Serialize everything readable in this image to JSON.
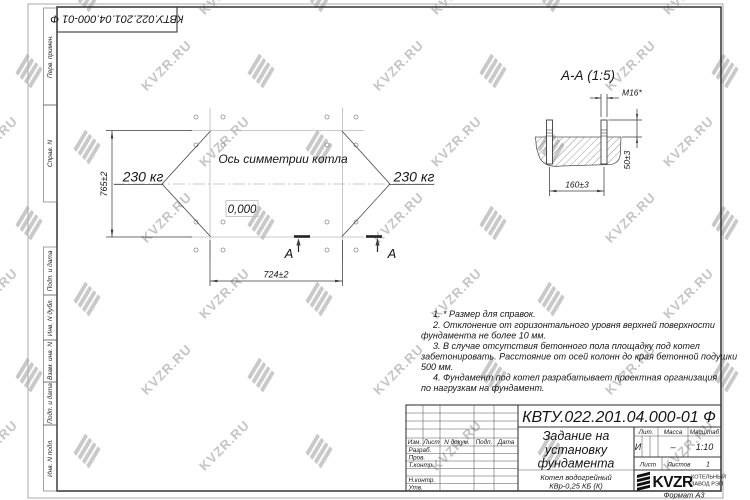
{
  "sheet": {
    "designation": "КВТУ.022.201.04.000-01 Ф",
    "format_label": "Формат А3",
    "watermark_text": "KVZR.RU"
  },
  "margin_labels": [
    "Перв. примен.",
    "Справ. N",
    "Подп. и дата",
    "Инв. N дубл.",
    "Взам. инв. N",
    "Подп. и дата",
    "Инв. N подл."
  ],
  "plan": {
    "axis_label": "Ось симметрии котла",
    "level_mark": "0,000",
    "load_left": "230 кг",
    "load_right": "230 кг",
    "dim_height": "765±2",
    "dim_width": "724±2",
    "section_letter": "А"
  },
  "section": {
    "title": "А-А (1:5)",
    "bolt_thread": "М16*",
    "dim_protrusion": "50±3",
    "dim_spacing": "160±3"
  },
  "notes": {
    "lines": [
      "1. * Размер для справок.",
      "2. Отклонение от горизонтального уровня верхней поверхности",
      "фундамента не более 10 мм.",
      "3. В случае отсутствия бетонного пола площадку под котел",
      "забетонировать. Расстояние от осей колонн до края бетонной подушки",
      "500 мм.",
      "4. Фундамент под котел разрабатывает проектная организация",
      "по нагрузкам на фундамент."
    ]
  },
  "title_block": {
    "designation": "КВТУ.022.201.04.000-01 Ф",
    "doc_title_lines": [
      "Задание на",
      "установку",
      "фундамента"
    ],
    "product_lines": [
      "Котел водогрейный",
      "КВр-0,25 КБ (К)"
    ],
    "header_cols": [
      "Изм.",
      "Лист",
      "N докум.",
      "Подп.",
      "Дата"
    ],
    "sign_rows": [
      "Разраб.",
      "Пров.",
      "Т.контр.",
      "Н.контр.",
      "Утв."
    ],
    "lit_header": [
      "Лит.",
      "Масса",
      "Масштаб"
    ],
    "lit_value": "И",
    "mass_value": "–",
    "scale_value": "1:10",
    "sheet_label": "Лист",
    "sheets_label": "Листов",
    "sheets_value": "1",
    "logo_text": "KVZR",
    "logo_sub1": "КОТЕЛЬНЫЙ",
    "logo_sub2": "ЗАВОД РЭП"
  }
}
